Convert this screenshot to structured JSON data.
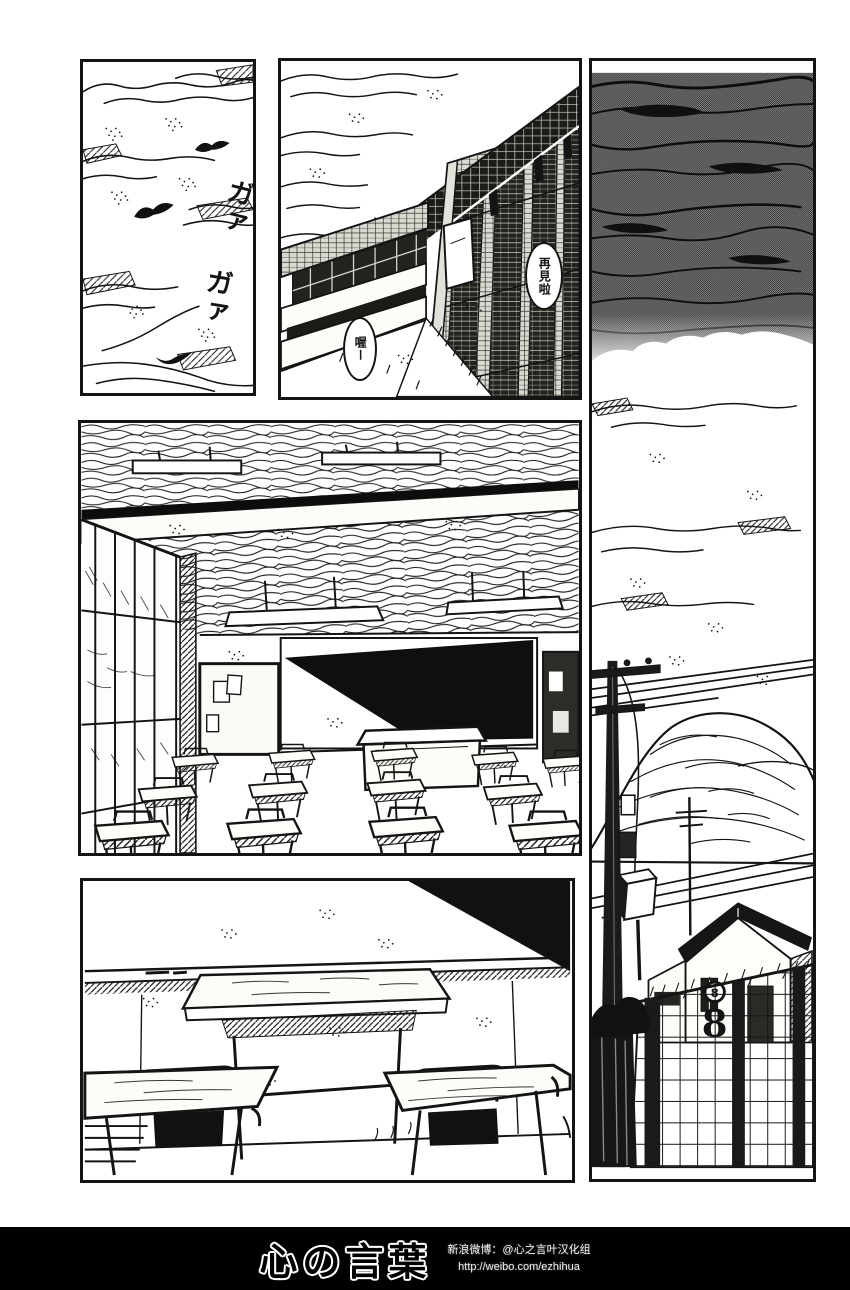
{
  "colors": {
    "ink": "#141414",
    "paper": "#ffffff",
    "halftone_sky": "#5f5f5f",
    "footer_bg": "#000000"
  },
  "panels": {
    "sky_crows": {
      "sfx": [
        "ガァ",
        "ガァ"
      ]
    },
    "school_building": {
      "bubble_farewell": "再見啦",
      "bubble_reply": "喔ー"
    },
    "street": {
      "gate_number": "8"
    }
  },
  "footer": {
    "logo": "心の言葉",
    "credit_weibo": "新浪微博：@心之言叶汉化组",
    "credit_url": "http://weibo.com/ezhihua"
  }
}
